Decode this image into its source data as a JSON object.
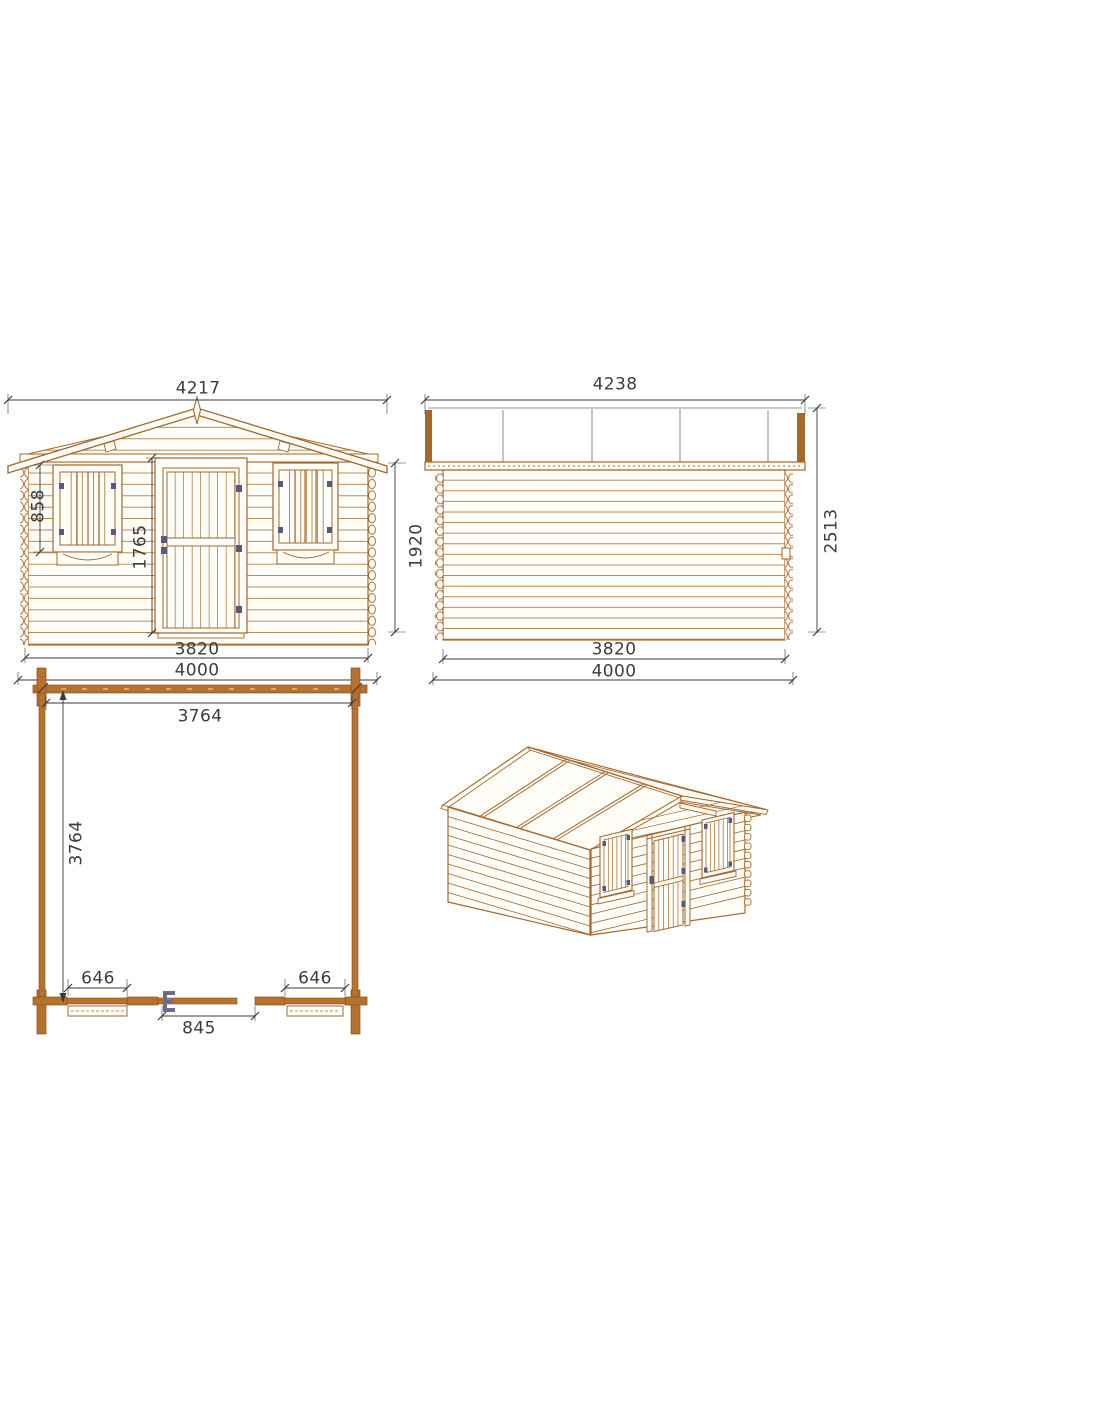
{
  "sheet": {
    "background": "#ffffff",
    "line_color": "#a5672a",
    "wood_fill": "#b5722c",
    "dim_text_color": "#3d3d3d",
    "hardware_color": "#585880"
  },
  "views": {
    "front_elevation": {
      "dims": {
        "roof_width": "4217",
        "window_height": "858",
        "door_height": "1765",
        "wall_width": "3820",
        "overall_width": "4000"
      }
    },
    "side_elevation": {
      "dims": {
        "roof_width": "4238",
        "wall_height": "1920",
        "total_height": "2513",
        "wall_depth": "3820",
        "overall_depth": "4000"
      }
    },
    "floor_plan": {
      "dims": {
        "inner_width": "3764",
        "inner_depth": "3764",
        "window_left_width": "646",
        "window_right_width": "646",
        "door_width": "845"
      }
    }
  }
}
